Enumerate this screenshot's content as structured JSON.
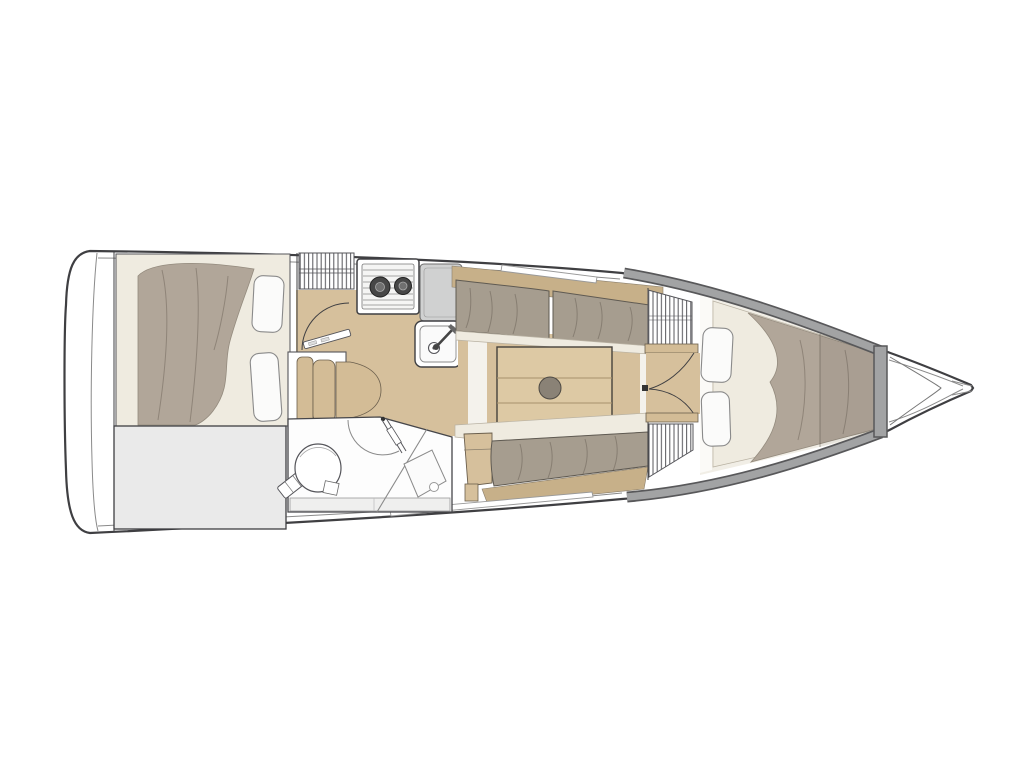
{
  "diagram": {
    "type": "yacht-interior-floor-plan",
    "view": "top-down",
    "orientation": "bow-right-stern-left",
    "regions": [
      "aft-cabin-double-berth",
      "aft-storage-locker",
      "companionway-steps",
      "galley",
      "head-with-shower",
      "salon-with-table-and-settees",
      "forward-v-berth-cabin",
      "anchor-locker-bow",
      "transom"
    ],
    "inventory": {
      "berth_pillows_aft": 2,
      "berth_pillows_forward": 2,
      "stove_burners": 2,
      "sinks": 1,
      "toilets": 1,
      "shower_pans": 1,
      "salon_tables": 1,
      "table_planks": 3,
      "companionway_steps": 3,
      "door_swings": 4,
      "hatched_lockers": 3,
      "settees": 2
    }
  },
  "colors": {
    "background": "#ffffff",
    "hull_line": "#3f3f42",
    "inner_line": "#8a8a8a",
    "wall_gray": "#a2a3a4",
    "wall_gray_dark": "#58585a",
    "floor_wood": "#d6c09c",
    "floor_wood_dark": "#c7b089",
    "table_wood": "#ddc9a4",
    "step_wood": "#d3bc96",
    "blanket_taupe": "#b1a699",
    "cushion_taupe": "#a69d8f",
    "mattress_cream": "#efebe0",
    "pillow_white": "#fbfbfa",
    "storage_gray": "#eaeaea",
    "counter_gray": "#d0d1d1",
    "room_white": "#fdfdfd",
    "table_leg": "#8a8276",
    "cabin_floor_cream": "#f1eee6"
  }
}
